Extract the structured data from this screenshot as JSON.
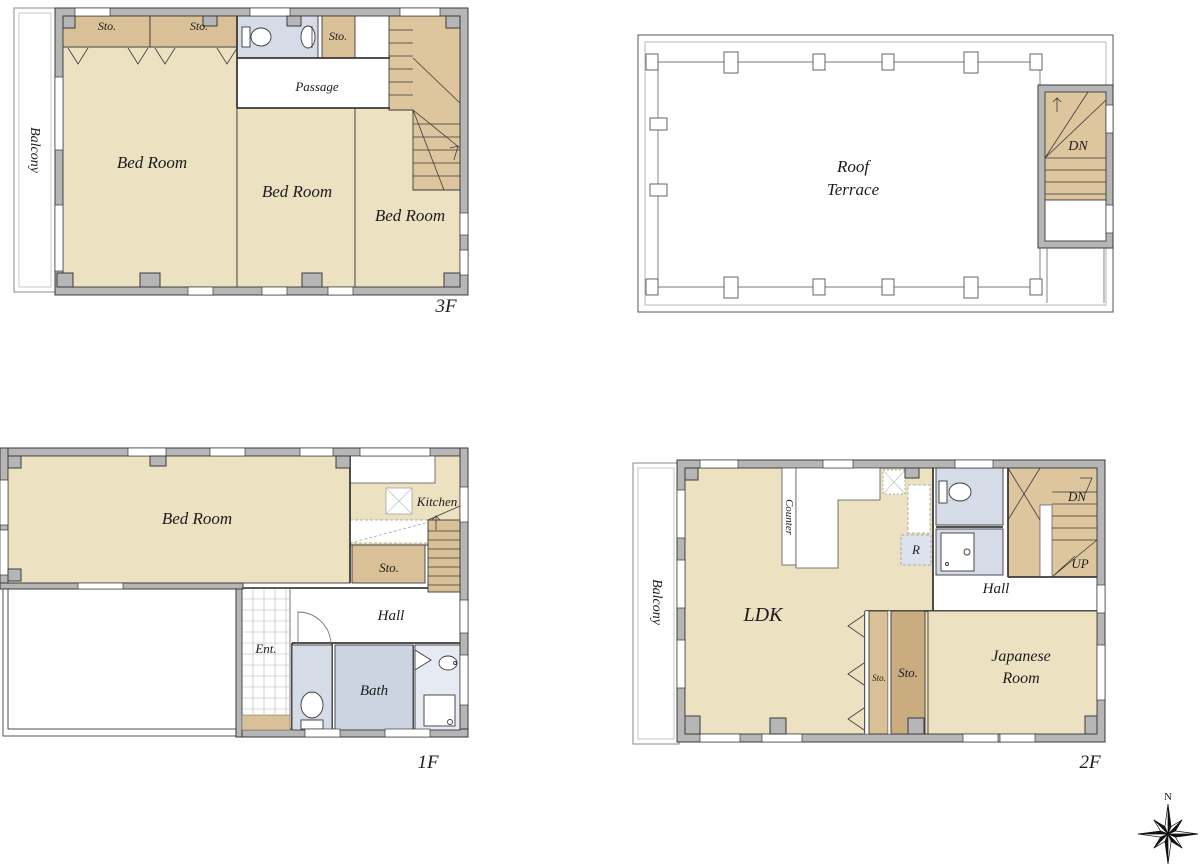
{
  "drawing_type": "residential floor plan set",
  "floor3": {
    "name": "3F",
    "balcony": "Balcony",
    "sto1": "Sto.",
    "sto2": "Sto.",
    "sto3": "Sto.",
    "passage": "Passage",
    "bedroom1": "Bed Room",
    "bedroom2": "Bed Room",
    "bedroom3": "Bed Room"
  },
  "roof": {
    "terrace_line1": "Roof",
    "terrace_line2": "Terrace",
    "stairs_down": "DN"
  },
  "floor1": {
    "name": "1F",
    "bedroom": "Bed Room",
    "kitchen": "Kitchen",
    "sto": "Sto.",
    "hall": "Hall",
    "entrance": "Ent.",
    "bath": "Bath"
  },
  "floor2": {
    "name": "2F",
    "balcony": "Balcony",
    "ldk": "LDK",
    "counter": "Counter",
    "refrigerator": "R",
    "stairs_down": "DN",
    "stairs_up": "UP",
    "hall": "Hall",
    "sto_small": "Sto.",
    "sto_large": "Sto.",
    "japanese_line1": "Japanese",
    "japanese_line2": "Room"
  },
  "compass": {
    "north": "N"
  },
  "colors": {
    "room_fill": "#ece1c1",
    "storage_fill": "#d9c097",
    "storage_dark_fill": "#c9ac80",
    "stairs_fill": "#ddc69e",
    "wet_room_fill": "#d5dbe7",
    "bath_fill": "#ccd4e2",
    "wall_fill": "#b6b6b6",
    "line": "#3a3a3a",
    "background": "#ffffff"
  }
}
